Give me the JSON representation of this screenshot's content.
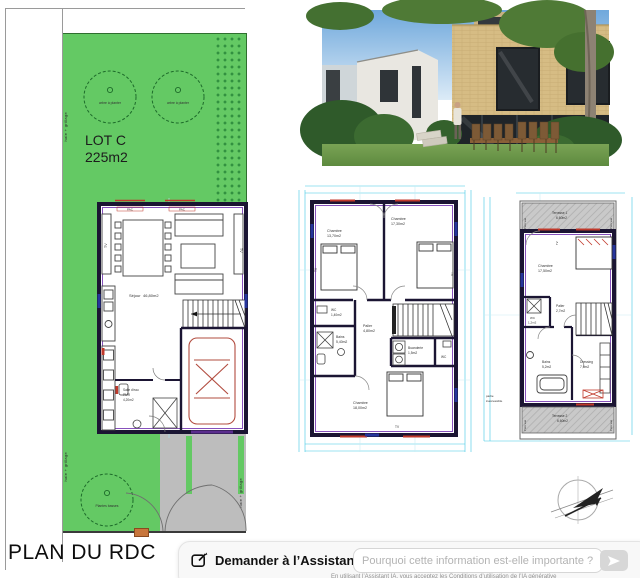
{
  "colors": {
    "lawn": "#64c964",
    "wall": "#1b1533",
    "wall_accent": "#7a3fb5",
    "dimension_cyan": "#3fc8e4",
    "dimension_red": "#c0392b",
    "terrace_gray": "#c9c9c9",
    "letterbox_orange": "#c8763c"
  },
  "page": {
    "title": "PLAN DU RDC"
  },
  "site": {
    "lot_name": "LOT C",
    "lot_area": "225m2",
    "tree1_label": "arbre à planter",
    "tree2_label": "arbre à planter",
    "shrubs_label": "Plantes basses",
    "fence_left_top": "haie + grillage",
    "fence_left_bottom": "haie + grillage",
    "fence_right": "haie + grillage"
  },
  "rdc": {
    "sejour_name": "Séjour",
    "sejour_area": "46,80m2",
    "salle_eau_name": "Salle d'eau",
    "salle_eau_sub": "PMR",
    "salle_eau_area": "4,20m2",
    "pac_left": "PAC",
    "pac_right": "PAC",
    "tv_left": "TV",
    "tv_right": "TV"
  },
  "etage1": {
    "chambre1_name": "Chambre",
    "chambre1_area": "13,70m2",
    "chambre2_name": "Chambre",
    "chambre2_area": "17,30m2",
    "chambre3_name": "Chambre",
    "chambre3_area": "18,00m2",
    "palier_name": "Palier",
    "palier_area": "4,80m2",
    "wc_name": "WC",
    "wc_area": "1,40m2",
    "bains_name": "Bains",
    "bains_area": "5,40m2",
    "buanderie_name": "Buanderie",
    "buanderie_area": "1,5m2",
    "wc2_name": "WC",
    "tv_left": "TV",
    "tv_right": "TV",
    "tv_bottom": "TV"
  },
  "etage2": {
    "terrasse1_name": "Terrasse 1",
    "terrasse1_area": "6,60m2",
    "chambre_name": "Chambre",
    "chambre_area": "17,50m2",
    "wc_name": "WC",
    "wc_area": "1,2m2",
    "palier_name": "Palier",
    "palier_area": "2,7m2",
    "bains_name": "Bains",
    "bains_area": "5,2m2",
    "dressing_name": "Dressing",
    "dressing_area": "7,6m2",
    "terrasse2_name": "Terrasse 2",
    "terrasse2_area": "6,60m2",
    "note_line1": "partie",
    "note_line2": "inaccessible",
    "pare_vue": "Pare vue",
    "tv": "TV"
  },
  "assistant": {
    "label": "Demander à l’Assistant IA",
    "placeholder": "Pourquoi cette information est-elle importante ?",
    "disclaimer": "En utilisant l’Assistant IA, vous acceptez les Conditions d’utilisation de l’IA générative"
  }
}
